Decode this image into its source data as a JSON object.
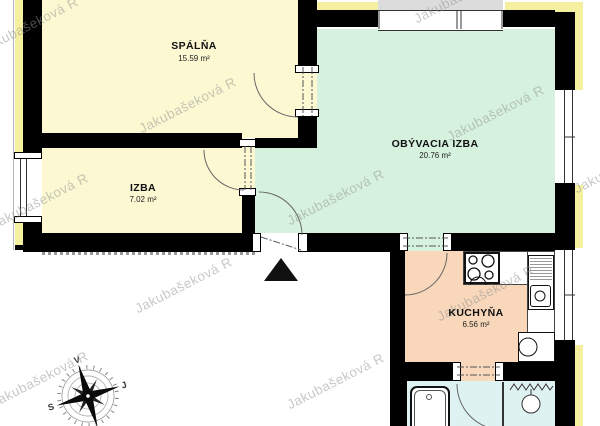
{
  "watermark": {
    "text": "Jakubašeková R"
  },
  "rooms": {
    "spalna": {
      "name": "SPÁLŇA",
      "area": "15.59 m²"
    },
    "izba": {
      "name": "IZBA",
      "area": "7.02 m²"
    },
    "obyvacia_izba": {
      "name": "OBÝVACIA IZBA",
      "area": "20.76 m²"
    },
    "kuchyna": {
      "name": "KUCHYŇA",
      "area": "6.56 m²"
    }
  },
  "compass": {
    "north_label": "S",
    "east_label": "V",
    "south_label": "J",
    "west_label": "Z"
  },
  "colors": {
    "room_bedroom": "#FBF8D2",
    "room_room": "#FBF8D2",
    "room_living": "#D6F1DD",
    "room_kitchen": "#F8D7BA",
    "room_bath": "#DEF2F1",
    "insulation": "#F5EFA0",
    "balcony_gray": "#DCDCDC",
    "wall": "#000000"
  }
}
